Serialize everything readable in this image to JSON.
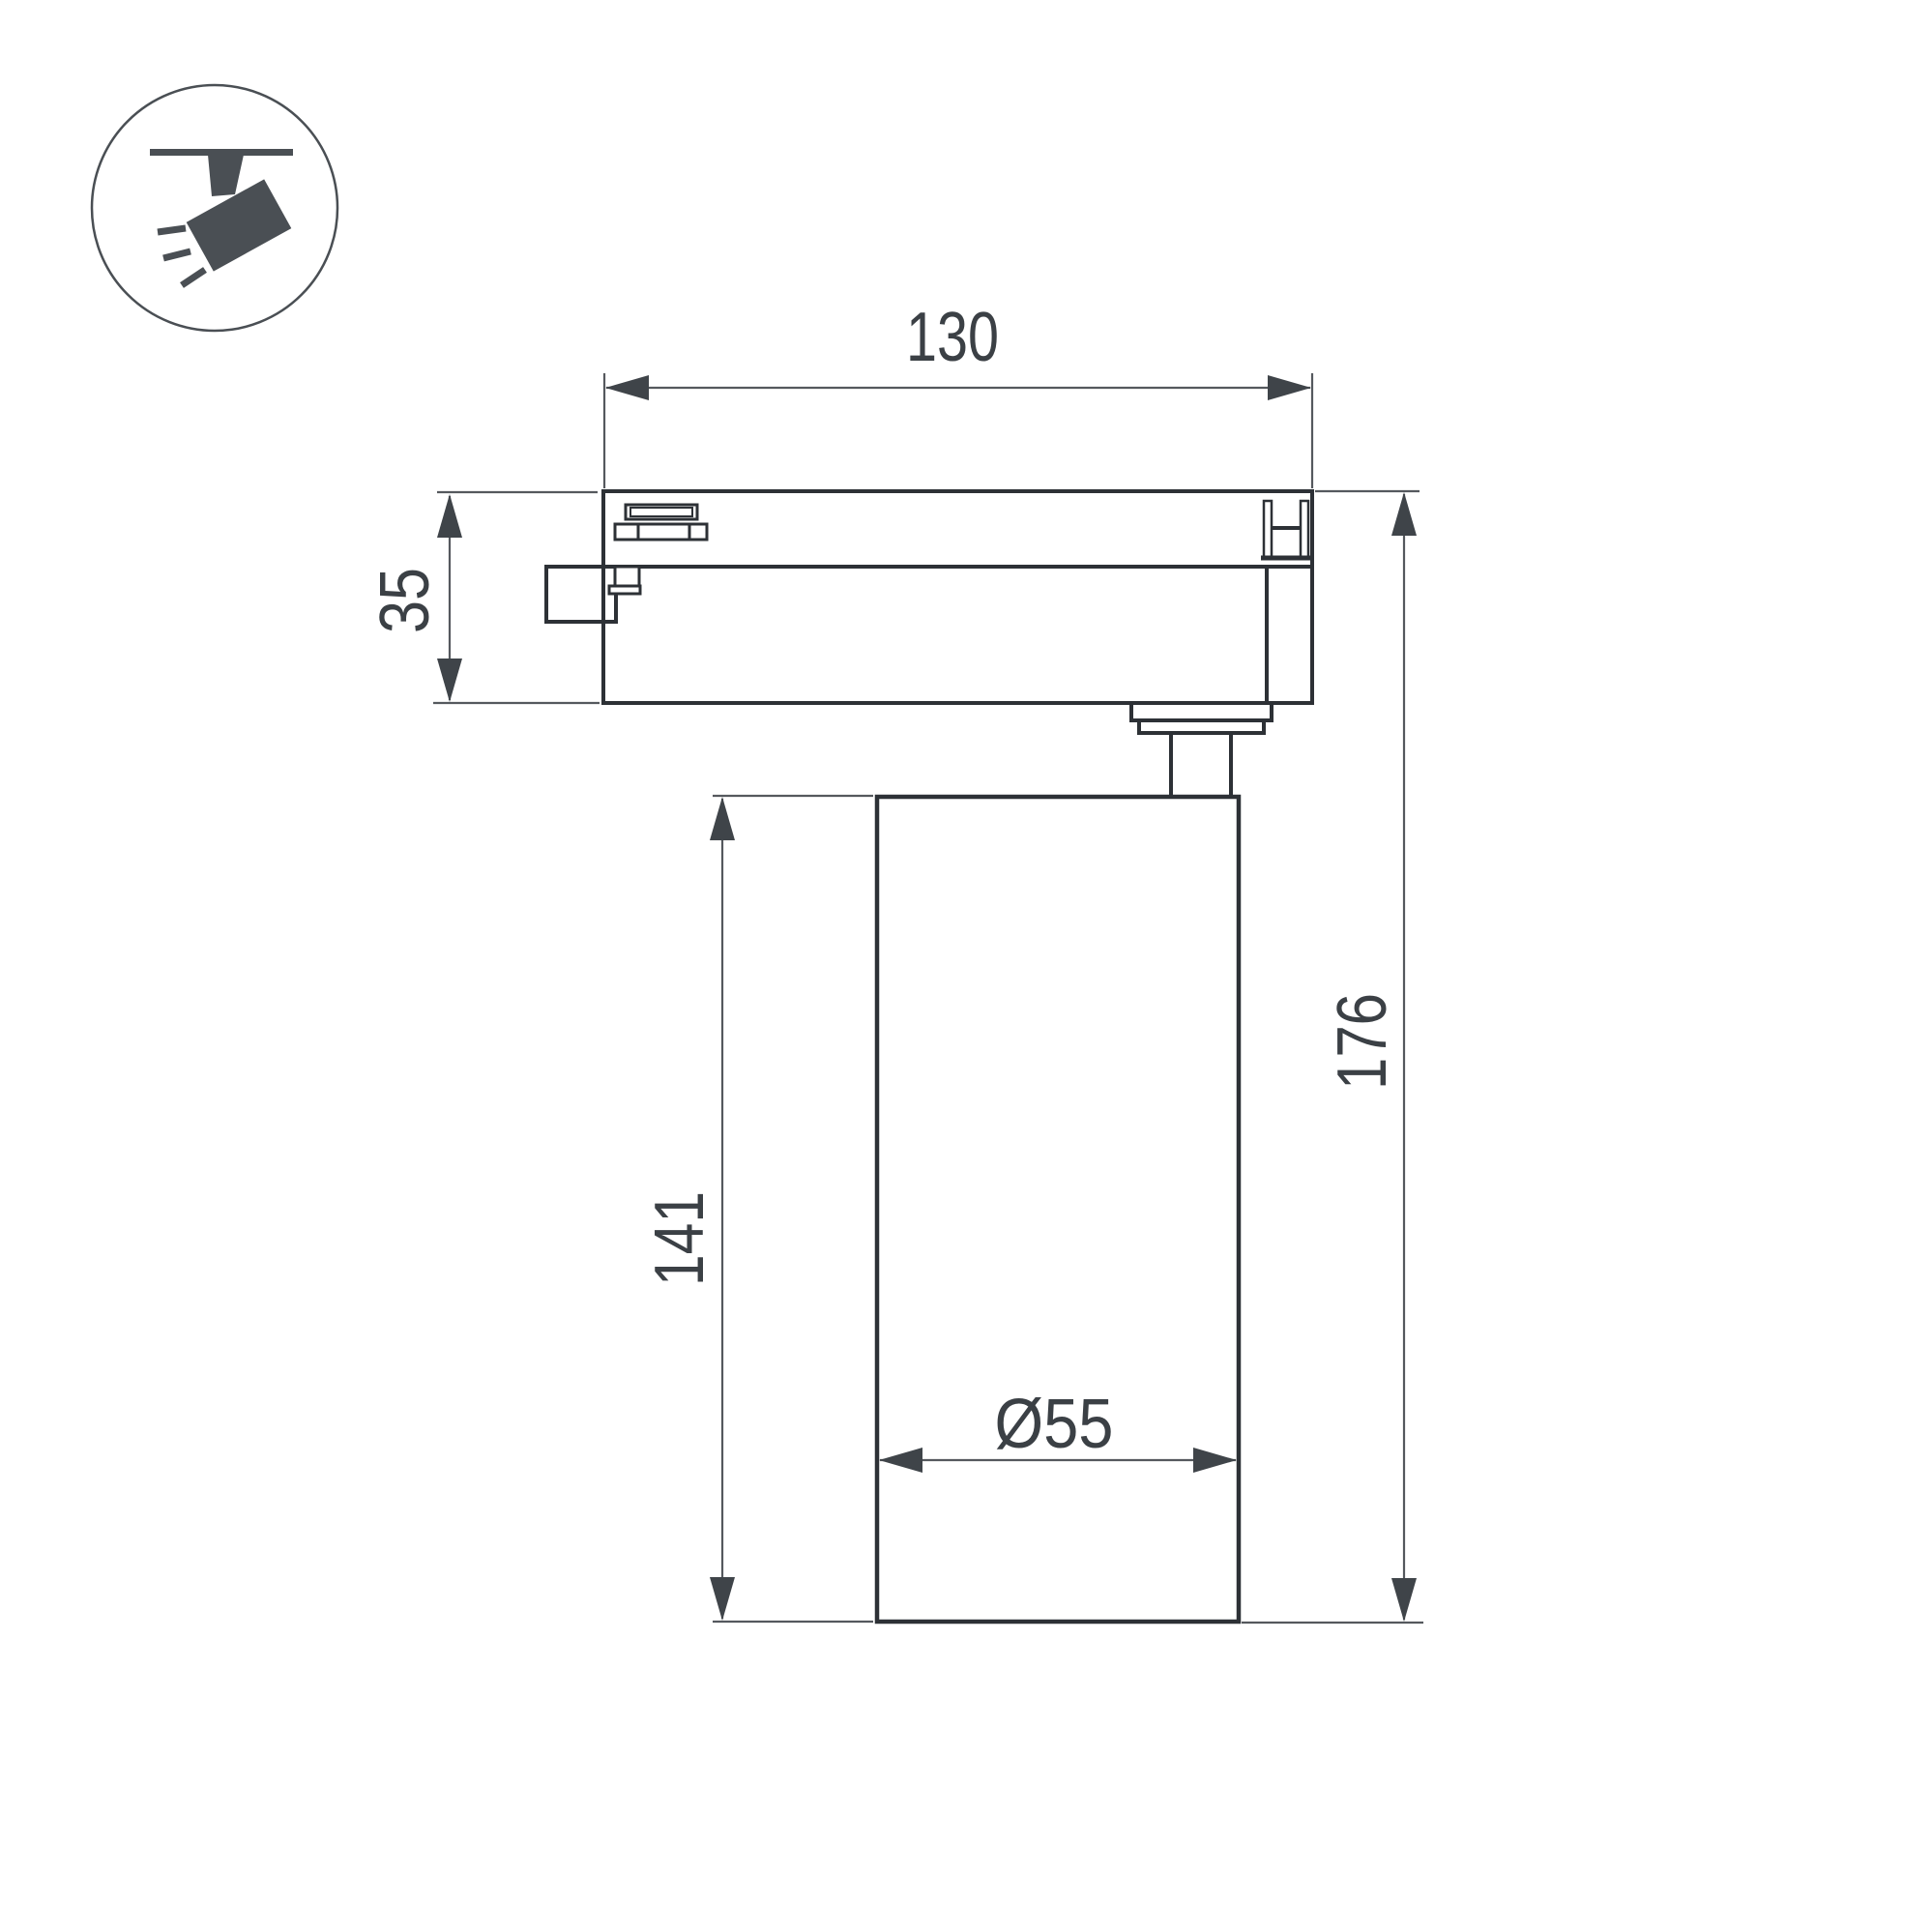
{
  "page": {
    "background": "#ffffff"
  },
  "legend_icon": {
    "name": "track-spotlight-icon"
  },
  "drawing": {
    "type": "technical-dimension-drawing",
    "subject": "LED track spotlight side view",
    "dimensions": {
      "track_width": {
        "label": "130",
        "value": 130
      },
      "adapter_height": {
        "label": "35",
        "value": 35
      },
      "body_height": {
        "label": "141",
        "value": 141
      },
      "total_height": {
        "label": "176",
        "value": 176
      },
      "body_diameter": {
        "label": "Ø55",
        "value": 55
      }
    },
    "colors": {
      "outline": "#2d3136",
      "dimension_line": "#55595e",
      "arrow": "#3f4449",
      "text": "#3b4045",
      "icon": "#4a4f54",
      "background": "#ffffff"
    }
  }
}
